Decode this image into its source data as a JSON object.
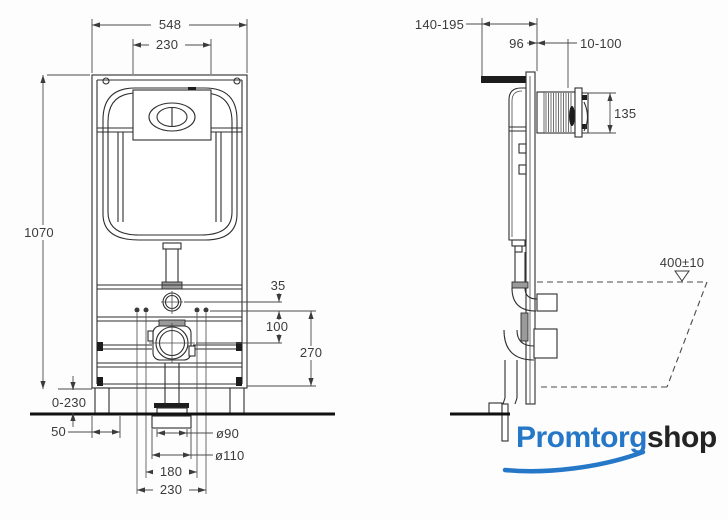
{
  "front_view": {
    "dim_frame_width": "548",
    "dim_plate_width": "230",
    "dim_frame_height": "1070",
    "dim_leg_adjustment": "0-230",
    "dim_side_offset": "50",
    "dim_inlet_offset": "35",
    "dim_inlet_to_drain": "100",
    "dim_drain_to_bottom": "270",
    "dim_drain_diameter": "ø90",
    "dim_outlet_diameter": "ø110",
    "dim_bolt_spacing_inner": "180",
    "dim_bolt_spacing_outer": "230"
  },
  "side_view": {
    "dim_install_depth": "140-195",
    "dim_frame_depth": "96",
    "dim_wall_finish": "10-100",
    "dim_plate_height": "135",
    "dim_bowl_height": "400±10"
  },
  "logo": {
    "brand_primary": "Promtorg",
    "brand_secondary": "shop"
  },
  "colors": {
    "logo_blue": "#2577c8",
    "logo_dark": "#232323",
    "line": "#2e2e2e"
  }
}
